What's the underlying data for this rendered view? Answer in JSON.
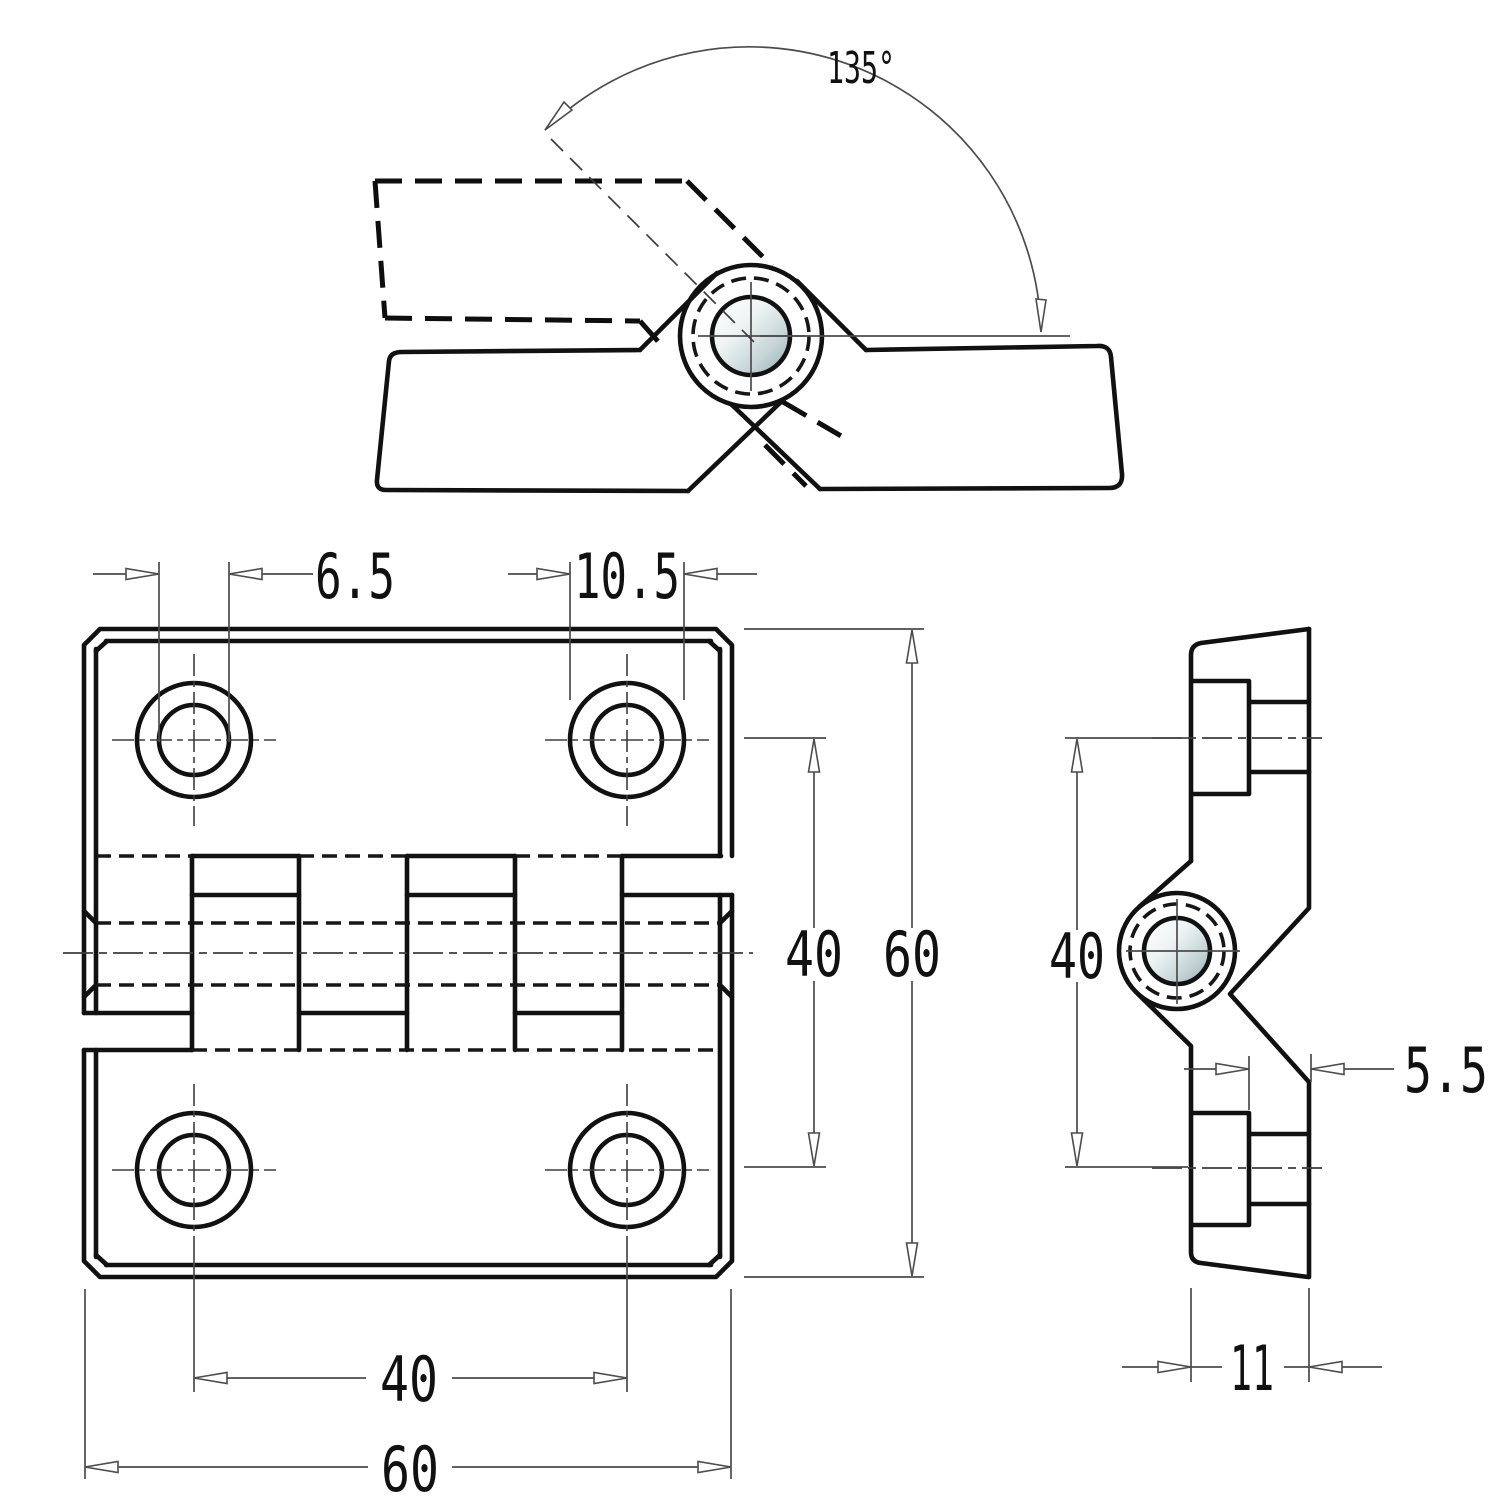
{
  "drawing": {
    "title_hint": "hinge technical drawing, three views",
    "angle": {
      "label": "135°"
    },
    "front_view": {
      "hole_diameter_label": "6.5",
      "counterbore_diameter_label": "10.5",
      "hole_spacing_vertical_label": "40",
      "height_label": "60",
      "hole_spacing_horizontal_label": "40",
      "width_label": "60"
    },
    "side_view": {
      "hole_spacing_label": "40",
      "leaf_thickness_label": "5.5",
      "total_thickness_label": "11"
    },
    "colors": {
      "line": "#111111",
      "thin_line": "#4c4c4c",
      "pin_shade_light": "#ffffff",
      "pin_shade_mid": "#dde8e9",
      "pin_shade_dark": "#92abb0",
      "background": "#ffffff"
    }
  }
}
